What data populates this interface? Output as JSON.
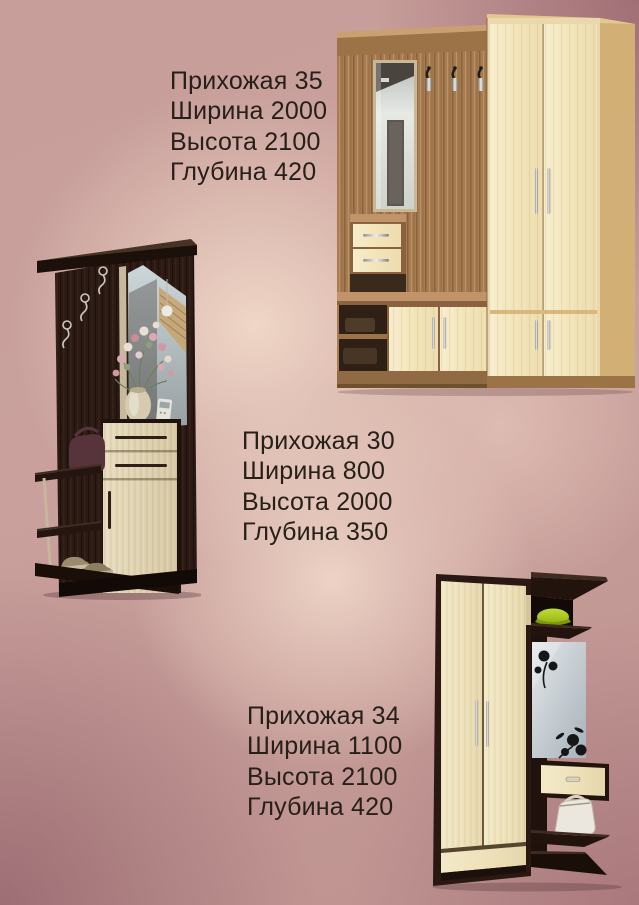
{
  "page": {
    "type": "furniture-catalog-flyer",
    "language": "ru",
    "background_colors": {
      "center_light": "#eed7c9",
      "edge_dark": "#9a6570",
      "base": "#c79e9a"
    },
    "text_color": "#272019"
  },
  "products": [
    {
      "title": "Прихожая 35",
      "specs": [
        "Ширина 2000",
        "Высота 2100",
        "Глубина 420"
      ],
      "photo_alt": "hallway wall unit: walnut frame, mirror, three coat hooks, drawer unit, bench shelves, cream two-door wardrobe",
      "photo_colors": {
        "wood": "#a87c52",
        "panel": "#f2e4b8"
      }
    },
    {
      "title": "Прихожая 30",
      "specs": [
        "Ширина 800",
        "Высота 2000",
        "Глубина 350"
      ],
      "photo_alt": "hallway unit: dark wenge panel with ornate hooks, angled mirror, vase with flowers, cream cabinet with two drawers, open shoe shelves with handbag and shoes",
      "photo_colors": {
        "wood": "#2b1a13",
        "panel": "#e0d4b4"
      }
    },
    {
      "title": "Прихожая 34",
      "specs": [
        "Ширина 1100",
        "Высота 2100",
        "Глубина 420"
      ],
      "photo_alt": "hallway unit: cream two-door wardrobe in wenge frame, top shelf with green cap, mirror with black floral decal, drawer, white handbag on open shelves",
      "photo_colors": {
        "wood": "#2a1812",
        "panel": "#efe3c0"
      }
    }
  ]
}
